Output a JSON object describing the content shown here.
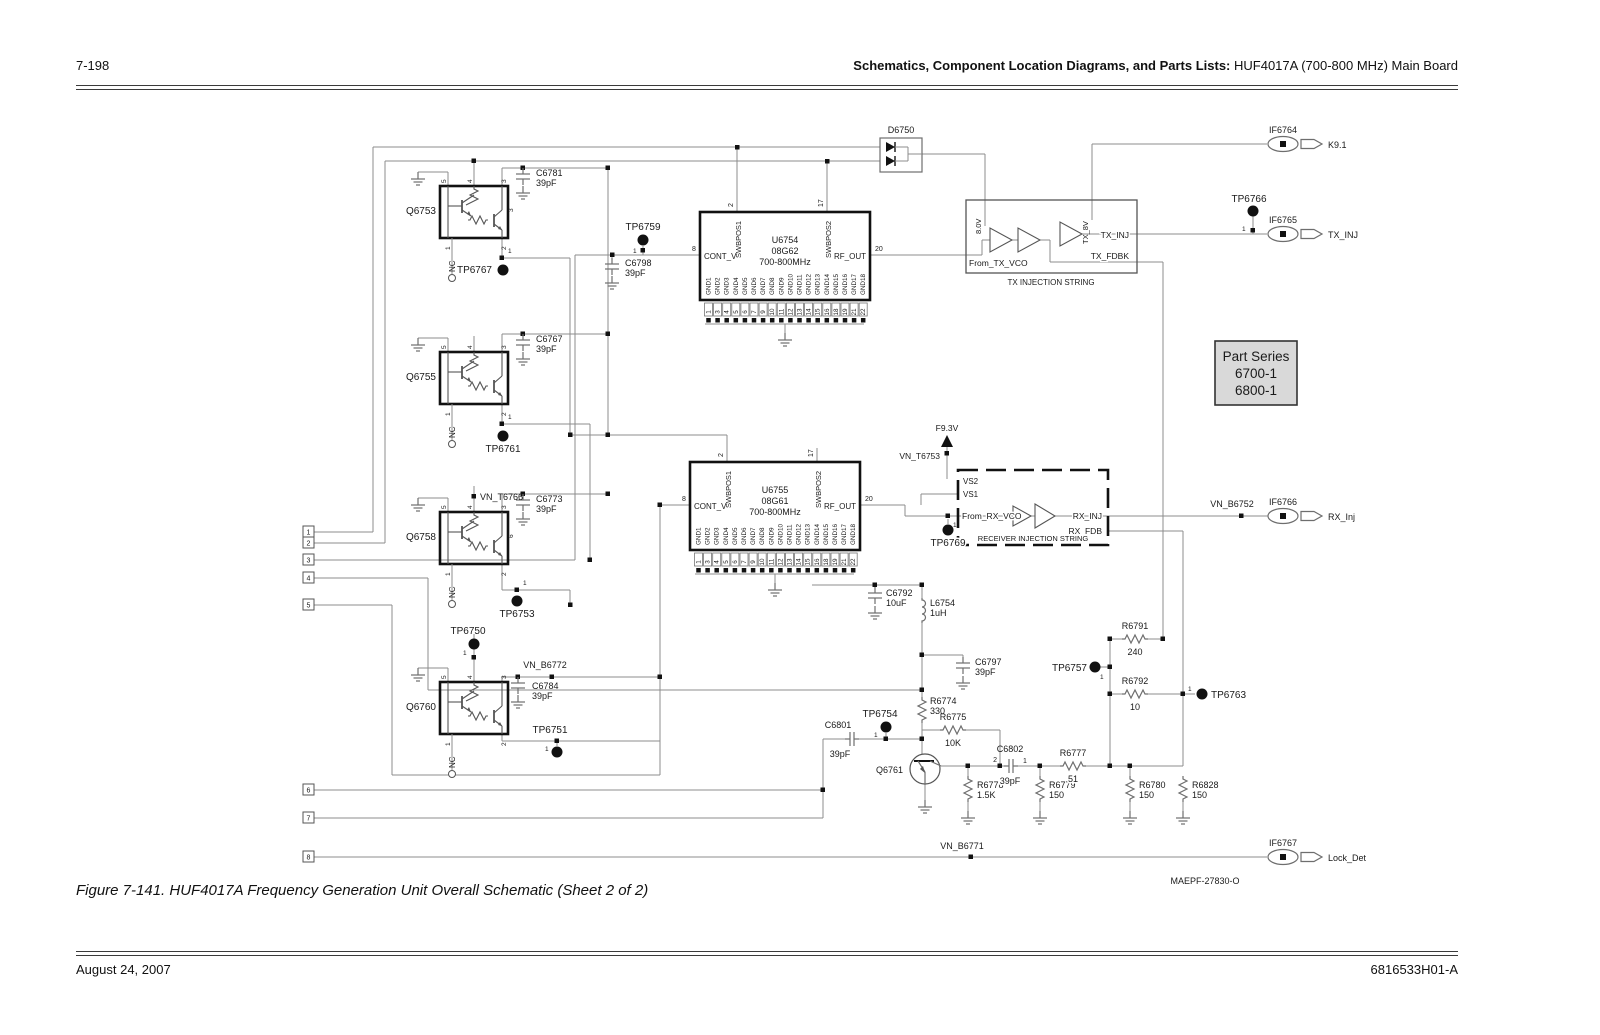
{
  "page": {
    "number": "7-198",
    "header_bold": "Schematics, Component Location Diagrams, and Parts Lists:",
    "header_normal": " HUF4017A (700-800 MHz) Main Board",
    "caption": "Figure 7-141. HUF4017A Frequency Generation Unit Overall Schematic (Sheet 2 of 2)",
    "footer_left": "August 24, 2007",
    "footer_right": "6816533H01-A",
    "drawing_number": "MAEPF-27830-O"
  },
  "note_box": {
    "title": "Part Series",
    "series1": "6700-1",
    "series2": "6800-1"
  },
  "ics": {
    "u6754": {
      "ref": "U6754",
      "part": "08G62",
      "freq": "700-800MHz"
    },
    "u6755": {
      "ref": "U6755",
      "part": "08G61",
      "freq": "700-800MHz"
    },
    "pins": {
      "left_num": "8",
      "left_name": "CONT_V",
      "right_num": "20",
      "right_name": "RF_OUT",
      "top1_num": "2",
      "top1_name": "SWBPOS1",
      "top2_num": "17",
      "top2_name": "SWBPOS2",
      "gnd_names": [
        "GND1",
        "GND2",
        "GND3",
        "GND4",
        "GND5",
        "GND6",
        "GND7",
        "GND8",
        "GND9",
        "GND10",
        "GND11",
        "GND12",
        "GND13",
        "GND14",
        "GND15",
        "GND16",
        "GND17",
        "GND18"
      ],
      "gnd_numbers": [
        "1",
        "3",
        "4",
        "5",
        "6",
        "7",
        "9",
        "10",
        "11",
        "12",
        "13",
        "14",
        "15",
        "16",
        "18",
        "19",
        "21",
        "22"
      ]
    }
  },
  "tx_string": {
    "supply": "8.0V",
    "supply2": "TX_8V",
    "input": "From_TX_VCO",
    "out1": "TX_INJ",
    "out2": "TX_FDBK",
    "label": "TX INJECTION STRING"
  },
  "rx_string": {
    "vs2": "VS2",
    "vs1": "VS1",
    "input": "From_RX_VCO",
    "out1": "RX_INJ",
    "out2": "RX_FDB",
    "label": "RECEIVER INJECTION STRING"
  },
  "outputs": {
    "k9": "K9.1",
    "tx_inj": "TX_INJ",
    "rx_inj": "RX_Inj",
    "lock_det": "Lock_Det"
  },
  "components": {
    "q6753": "Q6753",
    "q6755": "Q6755",
    "q6758": "Q6758",
    "q6760": "Q6760",
    "q6761": "Q6761",
    "d6750": "D6750",
    "c6781": "C6781",
    "c6767": "C6767",
    "c6773": "C6773",
    "c6784": "C6784",
    "c6798": "C6798",
    "c6792": "C6792",
    "c6797": "C6797",
    "c6801": "C6801",
    "c6802": "C6802",
    "l6754": "L6754",
    "r6774": "R6774",
    "r6775": "R6775",
    "r6777": "R6777",
    "r6778": "R6778",
    "r6779": "R6779",
    "r6780": "R6780",
    "r6828": "R6828",
    "r6791": "R6791",
    "r6792": "R6792",
    "if6764": "IF6764",
    "if6765": "IF6765",
    "if6766": "IF6766",
    "if6767": "IF6767"
  },
  "values": {
    "pf39": "39pF",
    "uf10": "10uF",
    "uh1": "1uH",
    "r330": "330",
    "r10k": "10K",
    "r51": "51",
    "r1_5k": "1.5K",
    "r150": "150",
    "r240": "240",
    "r10": "10"
  },
  "testpoints": {
    "tp6767": "TP6767",
    "tp6759": "TP6759",
    "tp6761": "TP6761",
    "tp6753": "TP6753",
    "tp6750": "TP6750",
    "tp6751": "TP6751",
    "tp6754": "TP6754",
    "tp6757": "TP6757",
    "tp6763": "TP6763",
    "tp6766": "TP6766",
    "tp6769": "TP6769"
  },
  "nets": {
    "vn_t6766": "VN_T6766",
    "vn_b6772": "VN_B6772",
    "vn_t6753": "VN_T6753",
    "vn_b6752": "VN_B6752",
    "vn_b6771": "VN_B6771",
    "f9_3v": "F9.3V"
  },
  "misc": {
    "nc": "NC",
    "pin1": "1",
    "pin2": "2",
    "pin3": "3",
    "pin4": "4",
    "pin5": "5",
    "pin6": "6"
  },
  "connectors": [
    "1",
    "2",
    "3",
    "4",
    "5",
    "6",
    "7",
    "8"
  ],
  "colors": {
    "wire": "#8c8c8c",
    "symbol": "#6e6e6e",
    "ink": "#111111",
    "note_fill": "#d9d9d9"
  }
}
